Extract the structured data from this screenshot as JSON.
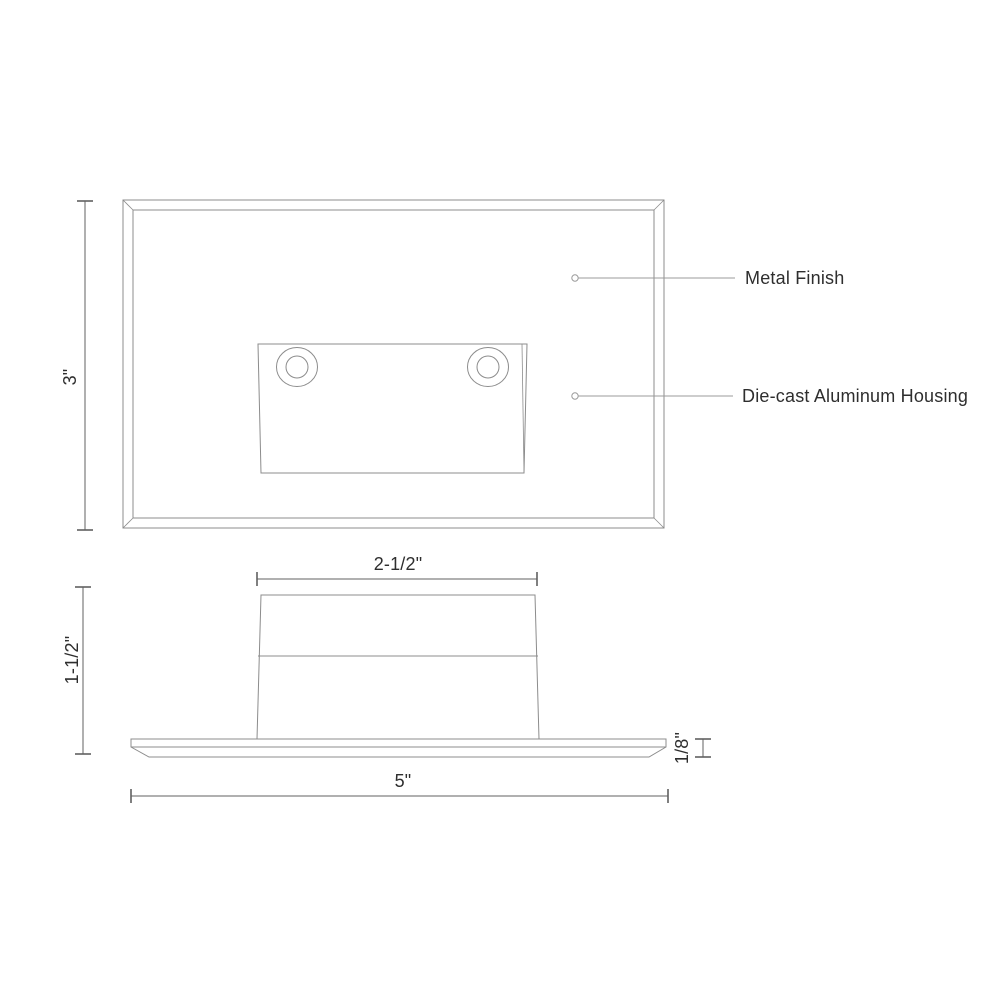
{
  "drawing": {
    "callouts": [
      {
        "label": "Metal Finish"
      },
      {
        "label": "Die-cast Aluminum Housing"
      }
    ],
    "dimensions": {
      "front_height": "3\"",
      "housing_top_width": "2-1/2\"",
      "side_height": "1-1/2\"",
      "faceplate_thickness": "1/8\"",
      "overall_width": "5\""
    },
    "colors": {
      "background": "#ffffff",
      "drawing_line": "#8c8c8c",
      "dimension_line": "#606060",
      "leader_line": "#9b9b9b",
      "text": "#2e2e2e"
    }
  }
}
